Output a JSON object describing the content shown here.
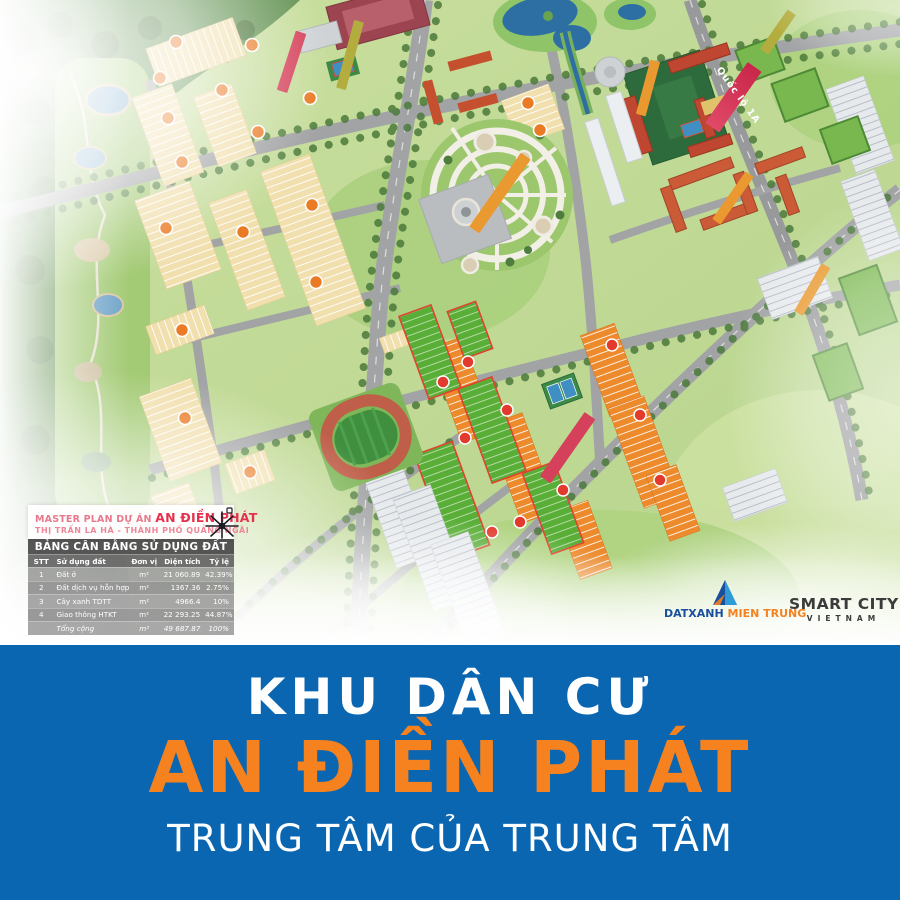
{
  "map": {
    "street_labels": [
      {
        "text": "Quốc lộ 1A",
        "color": "#d5284e"
      }
    ],
    "overlay_card": {
      "title_prefix": "MASTER PLAN DỰ ÁN ",
      "title_highlight": "AN ĐIỀN PHÁT",
      "subtitle": "THỊ TRẤN LA HÀ - THÀNH PHỐ QUẢNG NGÃI",
      "table": {
        "title": "BẢNG CÂN BẰNG SỬ DỤNG ĐẤT",
        "columns": [
          "STT",
          "Sử dụng đất",
          "Đơn vị",
          "Diện tích",
          "Tỷ lệ"
        ],
        "rows": [
          [
            "1",
            "Đất ở",
            "m²",
            "21 060.89",
            "42.39%"
          ],
          [
            "2",
            "Đất dịch vụ hỗn hợp",
            "m²",
            "1367.36",
            "2.75%"
          ],
          [
            "3",
            "Cây xanh TDTT",
            "m²",
            "4966.4",
            "10%"
          ],
          [
            "4",
            "Giao thông HTKT",
            "m²",
            "22 293.25",
            "44.87%"
          ],
          [
            "",
            "Tổng cộng",
            "m²",
            "49 687.87",
            "100%"
          ]
        ]
      }
    },
    "logos": {
      "datxanh": {
        "part1": "DATXANH ",
        "part2": "MIEN TRUNG"
      },
      "smartcity": {
        "line1": "SMART CITY",
        "line2": "VIETNAM"
      }
    }
  },
  "banner": {
    "line1": "KHU DÂN CƯ",
    "line2": "AN ĐIỀN PHÁT",
    "line3": "TRUNG TÂM CỦA TRUNG TÂM"
  },
  "colors": {
    "banner_blue": "#0b66b2",
    "accent_orange": "#f5821f",
    "card_pink": "#e8798d",
    "card_red": "#e5314d",
    "plot_cream": "#f1dfae",
    "roof_orange": "#ec8a2c",
    "lake_blue": "#2e6fa3",
    "street_banner_red": "#d5284e"
  }
}
